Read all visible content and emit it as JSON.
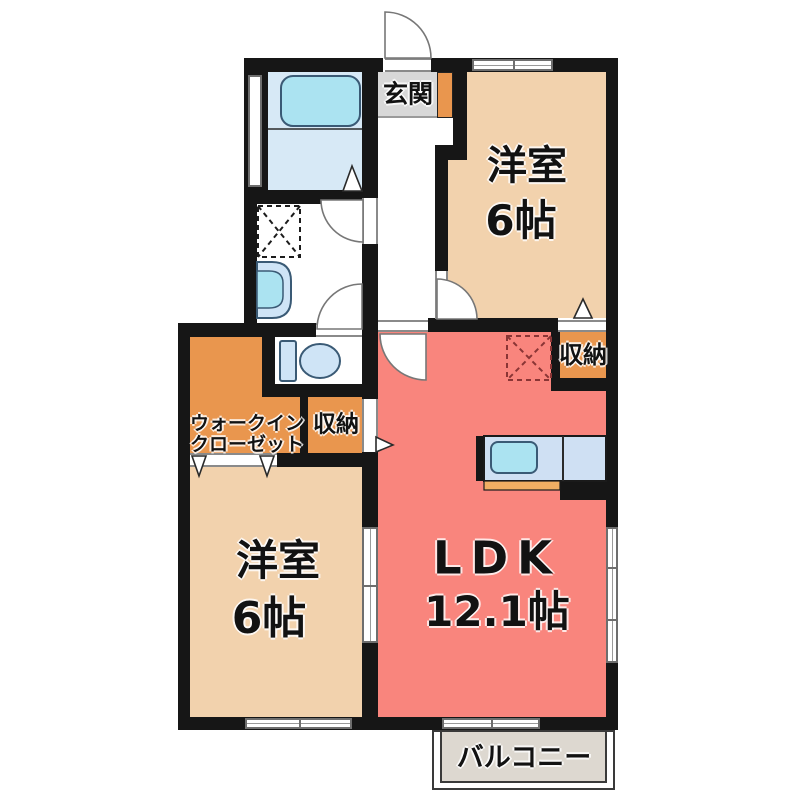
{
  "floorplan": {
    "entrance": "玄関",
    "bedroom_top": {
      "name": "洋室",
      "size": "6帖"
    },
    "bedroom_bottom": {
      "name": "洋室",
      "size": "6帖"
    },
    "ldk": {
      "name": "LDK",
      "size": "12.1帖"
    },
    "walk_in_closet": {
      "line1": "ウォークイン",
      "line2": "クローゼット"
    },
    "storage_top_right": "収納",
    "storage_center": "収納",
    "balcony": "バルコニー"
  },
  "colors": {
    "wall": "#161616",
    "bedroom_floor": "#f2d2ad",
    "ldk_floor": "#f9857d",
    "closet_floor": "#e9964e",
    "entrance_floor": "#d8d8d8",
    "bathroom_floor": "#d7e9f6",
    "fixture_blue": "#cfe4f6",
    "water_blue": "#abe3f1",
    "counter_blue": "#cfe0f3",
    "counter_front_orange": "#f0ae63",
    "balcony_floor": "#ddd8d0",
    "fridge_dash": "#8a3535",
    "outline": "#3a5a75"
  }
}
